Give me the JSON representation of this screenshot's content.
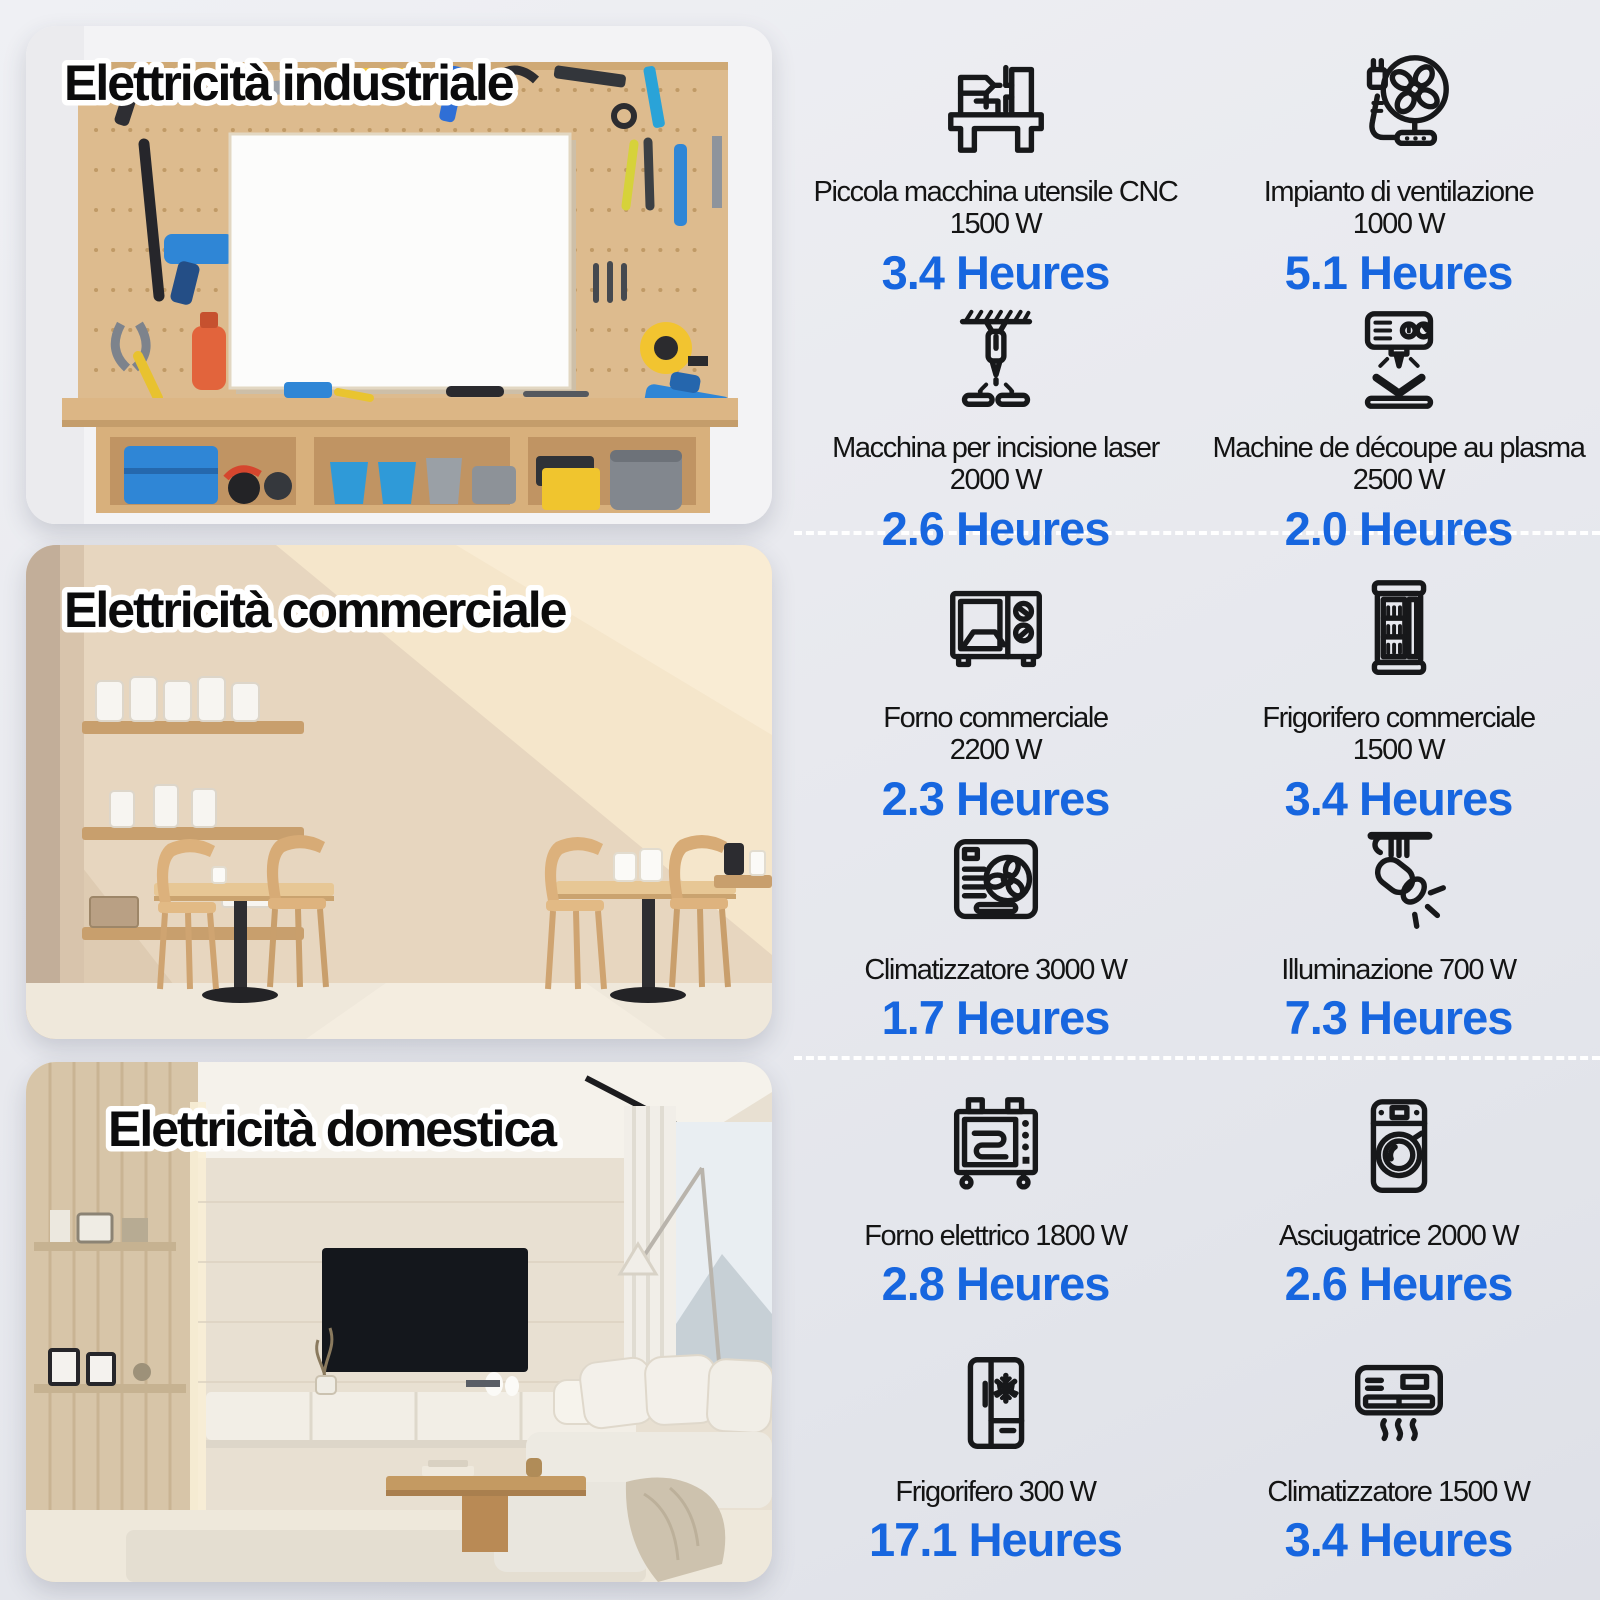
{
  "colors": {
    "accent_blue": "#1766df",
    "label_black": "#141414",
    "background_top": "#eff0f4",
    "background_bottom": "#dee0e7",
    "separator_white": "#ffffff"
  },
  "sections": [
    {
      "title": "Elettricità industriale",
      "items": [
        {
          "icon": "cnc-machine",
          "line1": "Piccola macchina utensile CNC",
          "line2": "1500 W",
          "hours": "3.4 Heures"
        },
        {
          "icon": "ventilation-fan",
          "line1": "Impianto di ventilazione",
          "line2": "1000 W",
          "hours": "5.1 Heures"
        },
        {
          "icon": "laser-engraver",
          "line1": "Macchina per incisione laser",
          "line2": "2000 W",
          "hours": "2.6 Heures"
        },
        {
          "icon": "plasma-cutter",
          "line1": "Machine de découpe au plasma",
          "line2": "2500 W",
          "hours": "2.0 Heures"
        }
      ]
    },
    {
      "title": "Elettricità commerciale",
      "items": [
        {
          "icon": "commercial-oven",
          "line1": "Forno commerciale",
          "line2": "2200 W",
          "hours": "2.3 Heures"
        },
        {
          "icon": "commercial-fridge",
          "line1": "Frigorifero commerciale",
          "line2": "1500 W",
          "hours": "3.4 Heures"
        },
        {
          "icon": "air-conditioner",
          "line1": "Climatizzatore 3000 W",
          "line2": "",
          "hours": "1.7 Heures"
        },
        {
          "icon": "spotlight",
          "line1": "Illuminazione 700 W",
          "line2": "",
          "hours": "7.3 Heures"
        }
      ]
    },
    {
      "title": "Elettricità domestica",
      "items": [
        {
          "icon": "electric-oven",
          "line1": "Forno elettrico 1800 W",
          "line2": "",
          "hours": "2.8 Heures"
        },
        {
          "icon": "dryer",
          "line1": "Asciugatrice 2000 W",
          "line2": "",
          "hours": "2.6 Heures"
        },
        {
          "icon": "refrigerator",
          "line1": "Frigorifero 300 W",
          "line2": "",
          "hours": "17.1 Heures"
        },
        {
          "icon": "wall-air-conditioner",
          "line1": "Climatizzatore 1500 W",
          "line2": "",
          "hours": "3.4 Heures"
        }
      ]
    }
  ]
}
